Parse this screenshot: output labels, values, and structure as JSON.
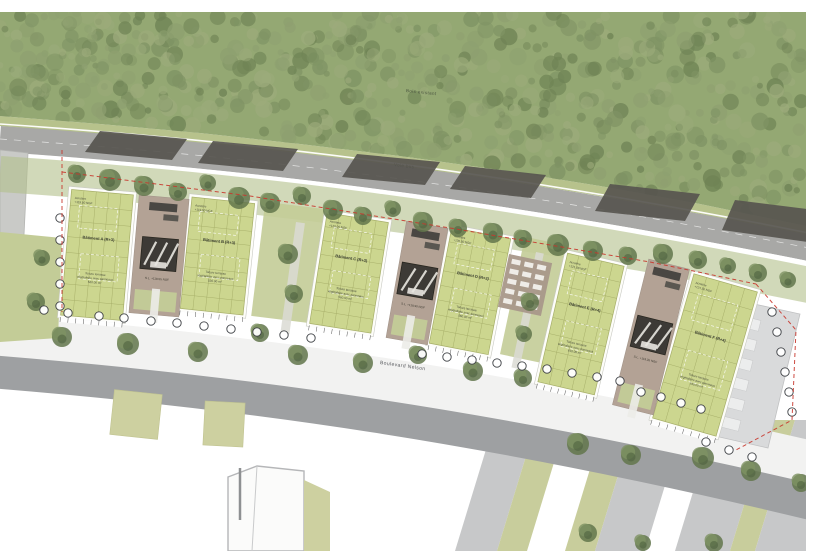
{
  "meta": {
    "description": "Architectural site plan rendering with six green-roof buildings along a curved boulevard, forest to the north"
  },
  "labels": {
    "forest": "Bois existant",
    "top_road": "Voie bus",
    "boulevard": "Boulevard Nelson"
  },
  "colors": {
    "forest": "#94a873",
    "forest_blob_1": "#6f8355",
    "forest_blob_2": "#7f9364",
    "forest_blob_3": "#8ea070",
    "forest_blob_4": "#9cab7b",
    "meadow": "#b7c28c",
    "verge": "#b2c08a",
    "lawn": "#c3cc97",
    "road": "#a8a8a6",
    "road_line": "#ffffff",
    "dark_strip": "#57554f",
    "roof": "#ccd68f",
    "roof_grid": "#a6ae68",
    "roof_border": "#fdfdf9",
    "courtyard": "#b3a295",
    "core": "#3d3a36",
    "canopy": "#4a4743",
    "sidewalk": "#f2f2f1",
    "boulevard": "#9ea0a2",
    "stripe_grey": "#c7c8c9",
    "stripe_green": "#c8cd9c",
    "beige": "#cdd0a0",
    "parking": "#d9dadb",
    "bay": "#eceded",
    "tree_base": "#62764b",
    "tree_mid": "#7e9263",
    "tree_dark": "#4f6340",
    "red_dash": "#c8372d",
    "marker_stroke": "#3f4246",
    "text": "#3c4032",
    "text_soft": "#4a4e3d"
  },
  "scene": {
    "forest_bottom": [
      [
        0,
        116
      ],
      [
        100,
        124
      ],
      [
        200,
        133
      ],
      [
        300,
        144
      ],
      [
        400,
        156
      ],
      [
        500,
        170
      ],
      [
        600,
        186
      ],
      [
        700,
        204
      ],
      [
        806,
        226
      ]
    ],
    "road_top_edge": "M0,124 C220,139 470,165 814,234",
    "road_center": "M0,139 C220,154 470,180 814,249",
    "road_bottom_edge": "M0,153 C220,168 470,194 814,263",
    "verge_band": "M0,174 C220,189 470,216 814,286",
    "sidewalk_band": "M-10,334 C240,354 490,387 820,464",
    "boulevard_band": "M-10,366 C240,386 490,420 820,500",
    "left_building": [
      [
        0,
        150
      ],
      [
        28,
        153
      ],
      [
        24,
        235
      ],
      [
        0,
        233
      ]
    ],
    "left_lawn": [
      [
        0,
        232
      ],
      [
        62,
        238
      ],
      [
        58,
        338
      ],
      [
        0,
        342
      ]
    ],
    "dark_strips": [
      [
        [
          100,
          131
        ],
        [
          187,
          139
        ],
        [
          172,
          160
        ],
        [
          85,
          152
        ]
      ],
      [
        [
          213,
          141
        ],
        [
          298,
          149
        ],
        [
          283,
          171
        ],
        [
          198,
          163
        ]
      ],
      [
        [
          357,
          154
        ],
        [
          440,
          162
        ],
        [
          425,
          185
        ],
        [
          342,
          177
        ]
      ],
      [
        [
          465,
          166
        ],
        [
          546,
          175
        ],
        [
          531,
          198
        ],
        [
          450,
          189
        ]
      ],
      [
        [
          610,
          184
        ],
        [
          700,
          194
        ],
        [
          685,
          221
        ],
        [
          595,
          211
        ]
      ],
      [
        [
          735,
          200
        ],
        [
          815,
          210
        ],
        [
          815,
          243
        ],
        [
          722,
          230
        ]
      ]
    ],
    "gap_lawns": [
      [
        258,
        205,
        60,
        115,
        7
      ],
      [
        512,
        240,
        44,
        120,
        12
      ]
    ],
    "walkways": [
      [
        296,
        222,
        9,
        112,
        8
      ],
      [
        536,
        252,
        8,
        118,
        12
      ]
    ],
    "stripes": [
      [
        455,
        42,
        "g"
      ],
      [
        497,
        30,
        "v"
      ],
      [
        565,
        30,
        "v"
      ],
      [
        595,
        50,
        "g"
      ],
      [
        675,
        55,
        "g"
      ],
      [
        730,
        25,
        "v"
      ],
      [
        755,
        60,
        "g"
      ]
    ],
    "beige_squares": [
      [
        112,
        392,
        48,
        45,
        6
      ],
      [
        204,
        402,
        40,
        44,
        3
      ]
    ],
    "bottom_building": [
      [
        228,
        477
      ],
      [
        257,
        466
      ],
      [
        304,
        471
      ],
      [
        304,
        551
      ],
      [
        228,
        551
      ]
    ],
    "bottom_ridge": [
      257,
      466,
      252,
      551
    ],
    "beige_wedge": [
      [
        304,
        480
      ],
      [
        330,
        492
      ],
      [
        330,
        551
      ],
      [
        304,
        551
      ]
    ],
    "pole": [
      240,
      468,
      240,
      520
    ],
    "parking_strip": [
      [
        736,
        300
      ],
      [
        800,
        314
      ],
      [
        768,
        448
      ],
      [
        706,
        434
      ]
    ],
    "parking_bays": [
      [
        740,
        318
      ],
      [
        736,
        338
      ],
      [
        732,
        358
      ],
      [
        728,
        378
      ],
      [
        724,
        398
      ],
      [
        720,
        418
      ]
    ],
    "terrace": {
      "x": 503,
      "y": 258,
      "w": 44,
      "h": 54,
      "rot": 12,
      "cols": 3,
      "rows": 5
    },
    "red_lines": [
      "62,150 62,312",
      "62,172 250,196 450,228 650,262 756,284",
      "756,284 796,330 792,420 736,450"
    ],
    "trees": [
      [
        75,
        172,
        9
      ],
      [
        108,
        178,
        11
      ],
      [
        142,
        184,
        10
      ],
      [
        176,
        190,
        9
      ],
      [
        206,
        181,
        8
      ],
      [
        237,
        196,
        11
      ],
      [
        268,
        201,
        10
      ],
      [
        300,
        194,
        9
      ],
      [
        331,
        208,
        10
      ],
      [
        361,
        214,
        9
      ],
      [
        391,
        207,
        8
      ],
      [
        421,
        220,
        10
      ],
      [
        456,
        226,
        9
      ],
      [
        491,
        231,
        10
      ],
      [
        521,
        237,
        9
      ],
      [
        556,
        243,
        11
      ],
      [
        591,
        249,
        10
      ],
      [
        626,
        254,
        9
      ],
      [
        661,
        252,
        10
      ],
      [
        696,
        258,
        9
      ],
      [
        726,
        264,
        8
      ],
      [
        756,
        271,
        9
      ],
      [
        786,
        278,
        8
      ],
      [
        40,
        256,
        8
      ],
      [
        34,
        300,
        9
      ],
      [
        286,
        252,
        10
      ],
      [
        292,
        292,
        9
      ],
      [
        528,
        300,
        9
      ],
      [
        522,
        332,
        8
      ],
      [
        60,
        335,
        10
      ],
      [
        126,
        342,
        11
      ],
      [
        196,
        350,
        10
      ],
      [
        258,
        331,
        9
      ],
      [
        296,
        353,
        10
      ],
      [
        361,
        361,
        10
      ],
      [
        416,
        353,
        9
      ],
      [
        471,
        369,
        10
      ],
      [
        521,
        376,
        9
      ],
      [
        576,
        442,
        11
      ],
      [
        629,
        453,
        10
      ],
      [
        586,
        531,
        9
      ],
      [
        701,
        456,
        11
      ],
      [
        749,
        469,
        10
      ],
      [
        799,
        481,
        9
      ],
      [
        641,
        541,
        8
      ],
      [
        712,
        541,
        9
      ]
    ],
    "markers": [
      [
        60,
        218
      ],
      [
        60,
        240
      ],
      [
        60,
        262
      ],
      [
        60,
        284
      ],
      [
        60,
        306
      ],
      [
        44,
        310
      ],
      [
        68,
        313
      ],
      [
        99,
        316
      ],
      [
        124,
        318
      ],
      [
        151,
        321
      ],
      [
        177,
        323
      ],
      [
        204,
        326
      ],
      [
        231,
        329
      ],
      [
        257,
        332
      ],
      [
        284,
        335
      ],
      [
        311,
        338
      ],
      [
        422,
        354
      ],
      [
        447,
        357
      ],
      [
        472,
        360
      ],
      [
        497,
        363
      ],
      [
        522,
        366
      ],
      [
        547,
        369
      ],
      [
        572,
        373
      ],
      [
        597,
        377
      ],
      [
        620,
        381
      ],
      [
        641,
        392
      ],
      [
        661,
        397
      ],
      [
        681,
        403
      ],
      [
        701,
        409
      ],
      [
        772,
        312
      ],
      [
        777,
        332
      ],
      [
        781,
        352
      ],
      [
        785,
        372
      ],
      [
        789,
        392
      ],
      [
        792,
        412
      ],
      [
        706,
        442
      ],
      [
        729,
        450
      ],
      [
        752,
        457
      ]
    ]
  },
  "buildings": [
    {
      "id": "A",
      "x": 66,
      "y": 192,
      "w": 62,
      "h": 126,
      "rot": 5,
      "acrotere": [
        "Acrotère",
        "+119.50 NGF"
      ],
      "title": "Bâtiment A (R+3)",
      "roof": [
        "Toiture terrasse",
        "végétalisée avec panneaux",
        "520.00 m²"
      ]
    },
    {
      "id": "B",
      "x": 186,
      "y": 200,
      "w": 63,
      "h": 112,
      "rot": 6,
      "acrotere": [
        "Acrotère",
        "+119.50 NGF"
      ],
      "title": "Bâtiment B (R+3)",
      "roof": [
        "Toiture terrasse",
        "végétalisée avec panneaux",
        "530.00 m²"
      ]
    },
    {
      "id": "C",
      "x": 318,
      "y": 217,
      "w": 62,
      "h": 112,
      "rot": 9,
      "acrotere": [
        "Acrotère",
        "+120.00 NGF"
      ],
      "title": "Bâtiment C (R+3)",
      "roof": [
        "Toiture terrasse",
        "végétalisée avec panneaux",
        "560.00 m²"
      ]
    },
    {
      "id": "D",
      "x": 440,
      "y": 232,
      "w": 60,
      "h": 118,
      "rot": 11,
      "acrotere": [
        "Acrotère",
        "+120.50 NGF"
      ],
      "title": "Bâtiment D (R+3)",
      "roof": [
        "Toiture terrasse",
        "végétalisée avec panneaux",
        "560.00 m²"
      ]
    },
    {
      "id": "E",
      "x": 552,
      "y": 258,
      "w": 58,
      "h": 132,
      "rot": 13,
      "acrotere": [
        "Acrotère",
        "+121.00 NGF"
      ],
      "title": "Bâtiment E (R+4)",
      "roof": [
        "Toiture terrasse",
        "végétalisée avec panneaux",
        "610.00 m²"
      ]
    },
    {
      "id": "F",
      "x": 672,
      "y": 280,
      "w": 66,
      "h": 150,
      "rot": 16,
      "acrotere": [
        "Acrotère",
        "+121.50 NGF"
      ],
      "title": "Bâtiment F (R+4)",
      "roof": [
        "Toiture terrasse",
        "végétalisée avec panneaux",
        "640.00 m²"
      ]
    }
  ],
  "courtyards": [
    {
      "id": "1",
      "x": 134,
      "y": 197,
      "w": 50,
      "h": 118,
      "rot": 5,
      "level": "S.L. +118.55 NGF"
    },
    {
      "id": "2",
      "x": 396,
      "y": 224,
      "w": 42,
      "h": 118,
      "rot": 10,
      "level": "S.L. +118.90 NGF"
    },
    {
      "id": "3",
      "x": 630,
      "y": 262,
      "w": 42,
      "h": 150,
      "rot": 14,
      "level": "S.L. +119.35 NGF"
    }
  ]
}
